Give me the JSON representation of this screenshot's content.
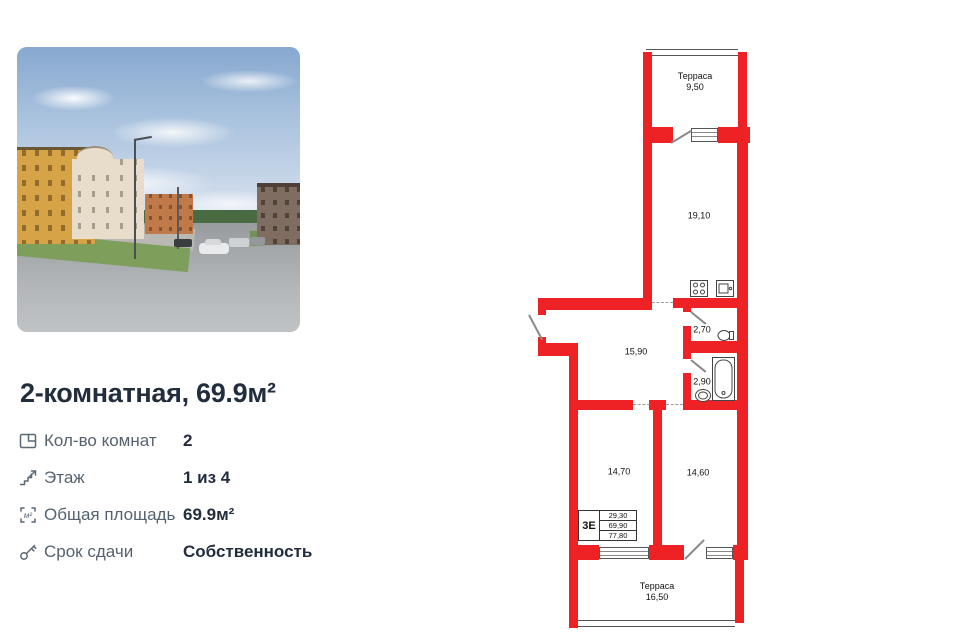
{
  "listing": {
    "title": "2-комнатная, 69.9м²",
    "photo": {
      "description": "street view of residential buildings"
    },
    "details": [
      {
        "icon": "rooms-icon",
        "label": "Кол-во комнат",
        "value": "2"
      },
      {
        "icon": "stairs-icon",
        "label": "Этаж",
        "value": "1 из 4"
      },
      {
        "icon": "area-icon",
        "label": "Общая площадь",
        "value": "69.9м²"
      },
      {
        "icon": "key-icon",
        "label": "Срок сдачи",
        "value": "Собственность"
      }
    ]
  },
  "floor_plan": {
    "colors": {
      "wall": "#ee2124"
    },
    "rooms": {
      "terrace_top": {
        "label": "Терраса",
        "area": "9,50"
      },
      "living_kitchen": {
        "area": "19,10"
      },
      "hall": {
        "area": "15,90"
      },
      "wc": {
        "area": "2,70"
      },
      "bathroom": {
        "area": "2,90"
      },
      "bedroom_left": {
        "area": "14,70"
      },
      "bedroom_right": {
        "area": "14,60"
      },
      "terrace_bottom": {
        "label": "Терраса",
        "area": "16,50"
      }
    },
    "stamp": {
      "series": "3Е",
      "values": [
        "29,30",
        "69,90",
        "77,80"
      ]
    },
    "fixtures": [
      "stove-icon",
      "kitchen-sink-icon",
      "toilet-icon",
      "bathtub-icon",
      "washbasin-icon"
    ]
  }
}
